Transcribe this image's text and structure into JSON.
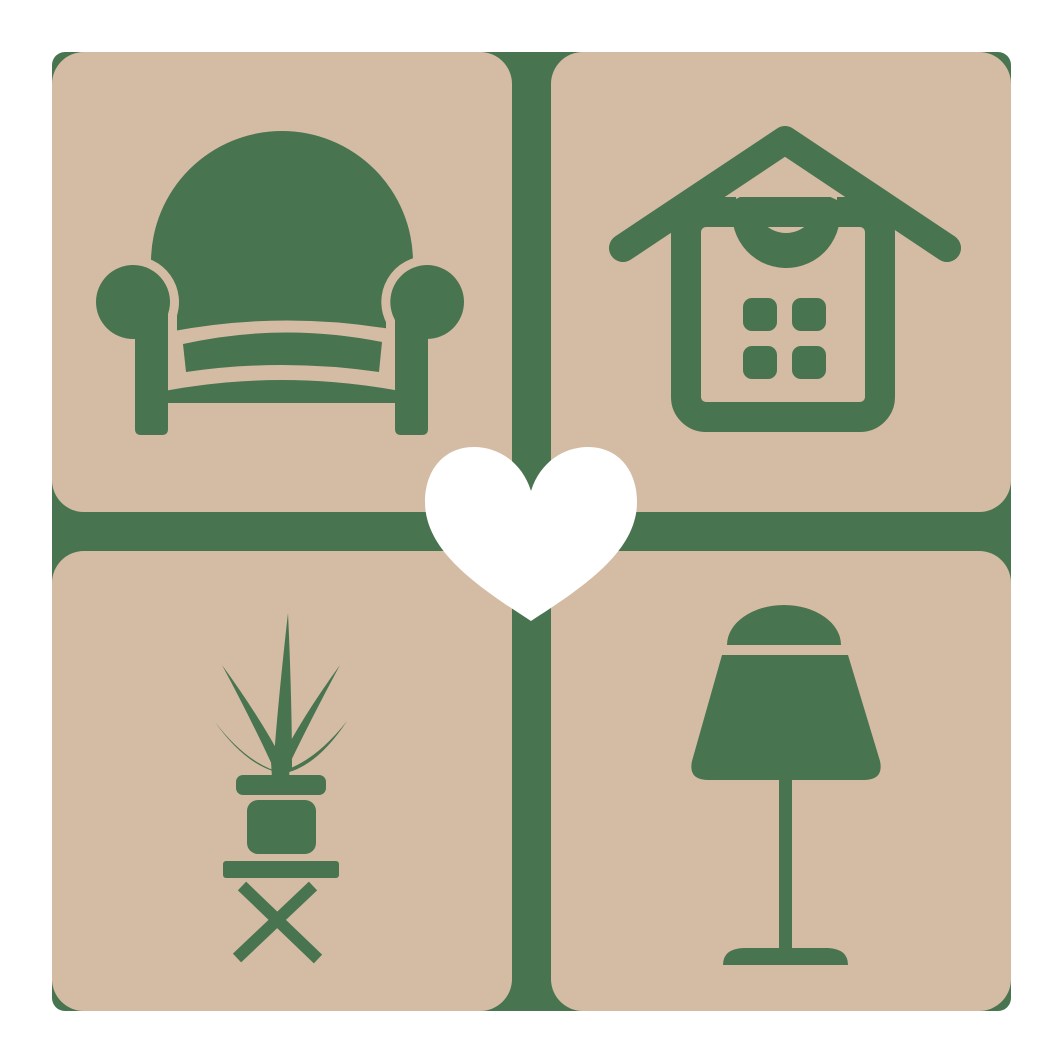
{
  "logo": {
    "description": "home decor logo: four beige rounded tiles on a green backplate with a white heart at the center",
    "colors": {
      "page_background": "#ffffff",
      "tile": "#d4bca4",
      "icon_green": "#497450",
      "heart": "#ffffff"
    },
    "tiles": [
      {
        "id": "armchair",
        "icon": "armchair-icon"
      },
      {
        "id": "house",
        "icon": "house-icon"
      },
      {
        "id": "potted-plant",
        "icon": "potted-plant-icon"
      },
      {
        "id": "table-lamp",
        "icon": "table-lamp-icon"
      }
    ],
    "center_icon": "heart-icon"
  }
}
